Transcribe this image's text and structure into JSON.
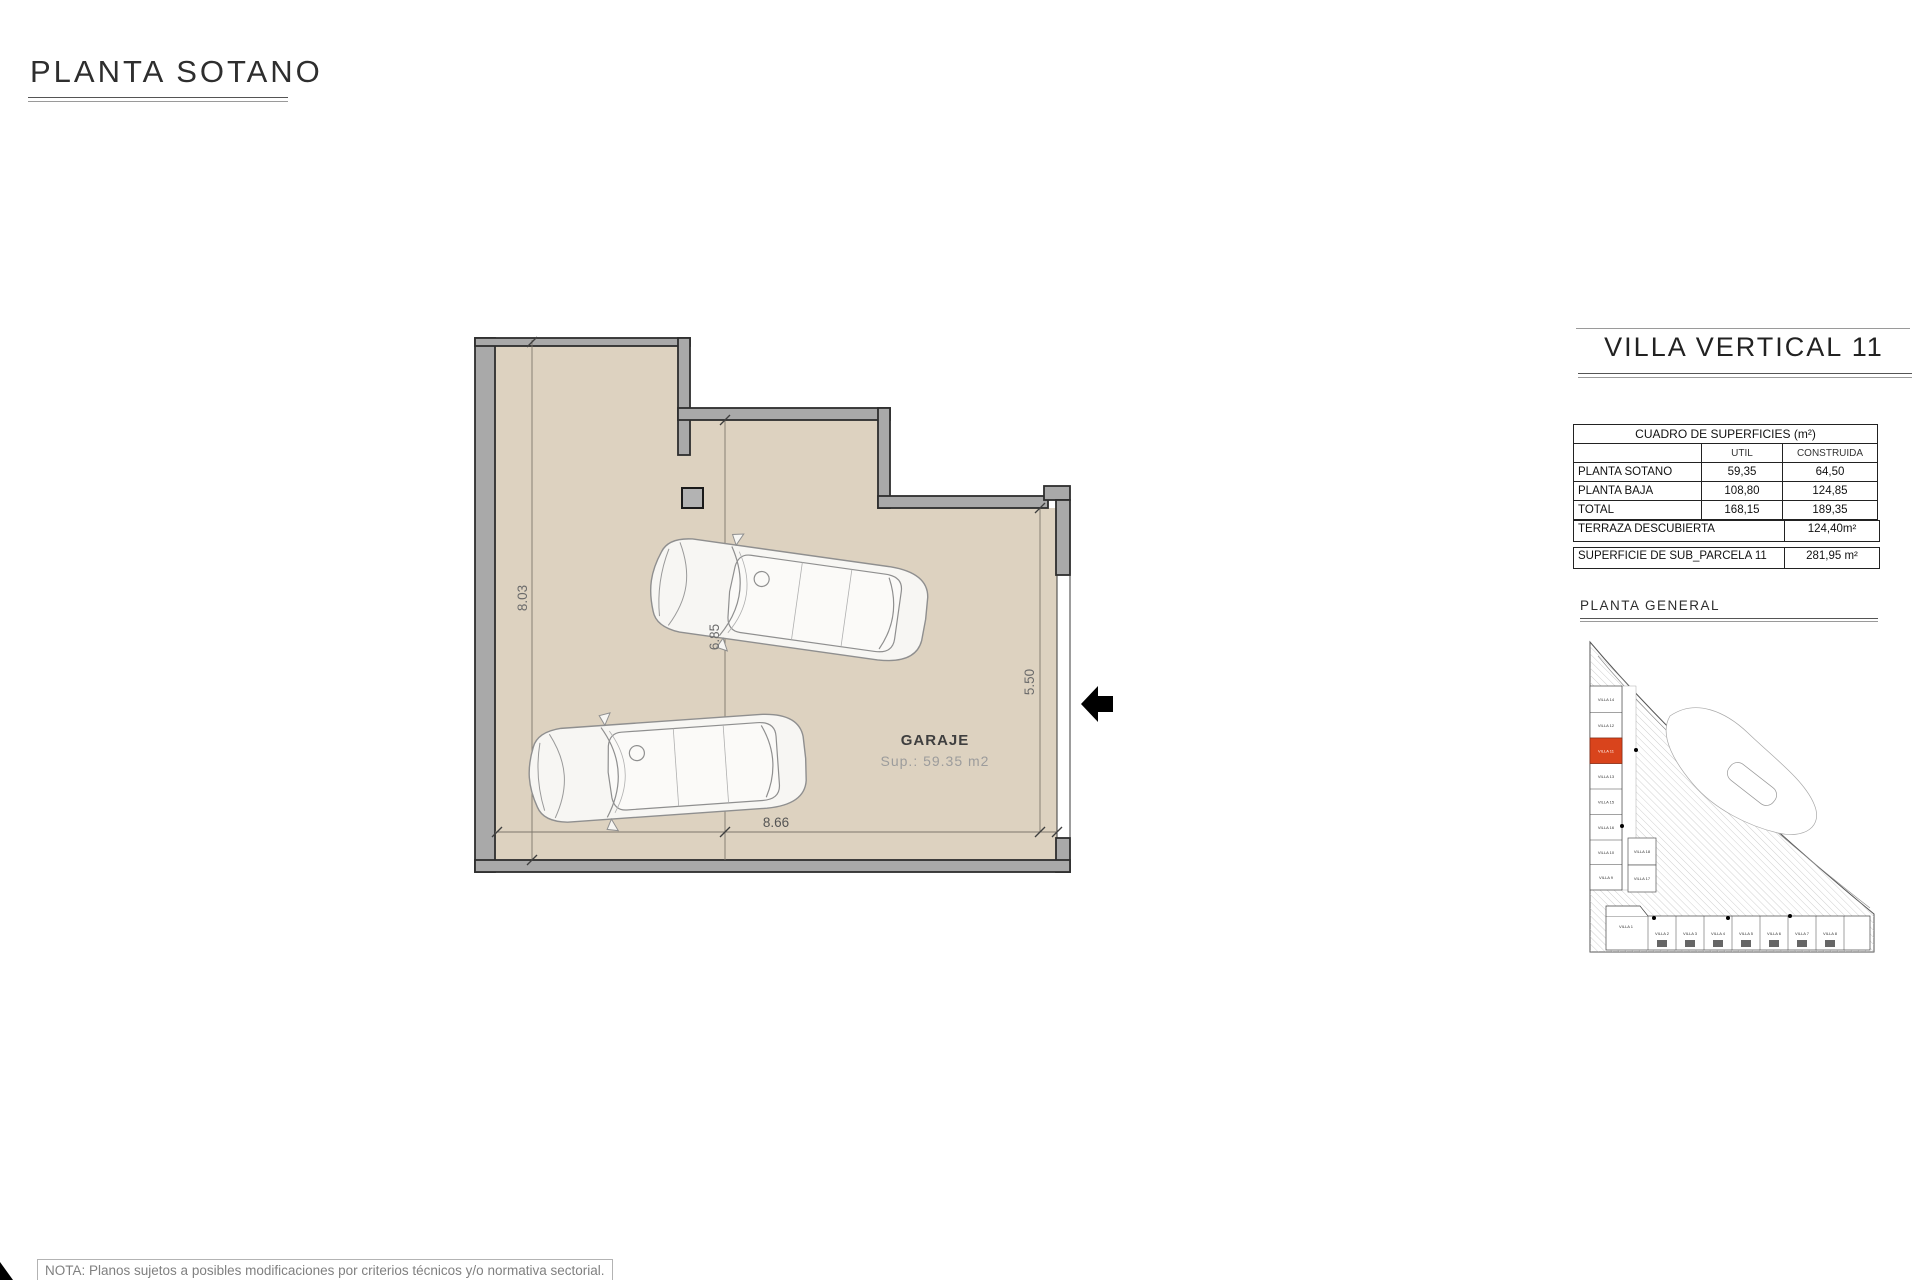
{
  "page": {
    "title": "PLANTA SOTANO",
    "note": "NOTA: Planos sujetos a posibles modificaciones por criterios técnicos y/o normativa sectorial."
  },
  "plan": {
    "room_label": "GARAJE",
    "room_area": "Sup.: 59.35 m2",
    "dimensions": {
      "left_height": "8.03",
      "inner_height": "6.85",
      "right_height": "5.50",
      "bottom_width": "8.66"
    }
  },
  "panel": {
    "title": "VILLA VERTICAL 11",
    "table": {
      "header": "CUADRO DE SUPERFICIES (m²)",
      "col_util": "UTIL",
      "col_construida": "CONSTRUIDA",
      "rows": [
        {
          "label": "PLANTA SOTANO",
          "util": "59,35",
          "construida": "64,50"
        },
        {
          "label": "PLANTA BAJA",
          "util": "108,80",
          "construida": "124,85"
        },
        {
          "label": "TOTAL",
          "util": "168,15",
          "construida": "189,35"
        }
      ]
    },
    "terraza": {
      "label": "TERRAZA DESCUBIERTA",
      "value": "124,40m²"
    },
    "parcela": {
      "label": "SUPERFICIE DE SUB_PARCELA 11",
      "value": "281,95 m²"
    },
    "site_plan_title": "PLANTA GENERAL",
    "site": {
      "highlighted": "VILLA 11",
      "highlight_color": "#d9441c",
      "left_column": [
        "VILLA 14",
        "VILLA 12",
        "VILLA 11",
        "VILLA 13",
        "VILLA 15",
        "VILLA 16",
        "VILLA 10",
        "VILLA 9"
      ],
      "middle": [
        "VILLA 18",
        "VILLA 17"
      ],
      "bottom_row": [
        "VILLA 1",
        "VILLA 2",
        "VILLA 3",
        "VILLA 4",
        "VILLA 5",
        "VILLA 6",
        "VILLA 7",
        "VILLA 8"
      ]
    }
  },
  "colors": {
    "floor": "#ddd2c0",
    "wall": "#a9a9a9",
    "wall_outline": "#2d2d2d",
    "highlight": "#d9441c",
    "dim_text": "#6b6b6b"
  }
}
